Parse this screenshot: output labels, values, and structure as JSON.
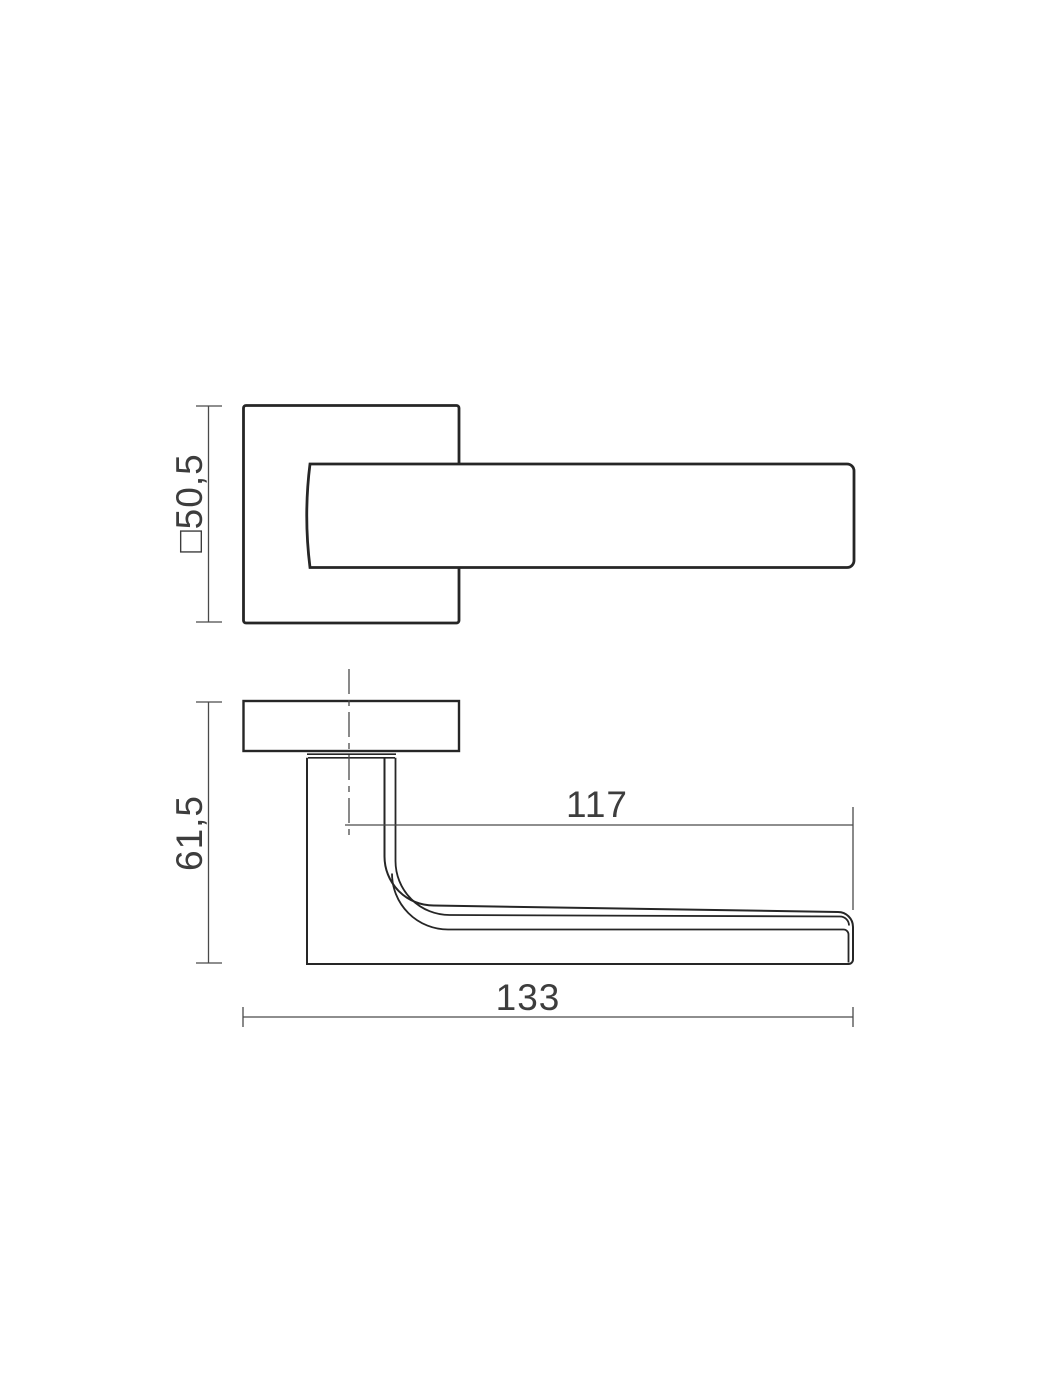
{
  "drawing": {
    "type": "technical-drawing",
    "subject": "door-handle-on-square-rose",
    "colors": {
      "background": "#ffffff",
      "object_line": "#262626",
      "dimension_line": "#4a4a4a",
      "label_text": "#3d3d3d"
    },
    "views": {
      "top": {
        "dimensions": {
          "rose_square": "□50,5"
        }
      },
      "side": {
        "dimensions": {
          "height": "61,5",
          "grip_length": "117",
          "total_length": "133"
        }
      }
    }
  }
}
